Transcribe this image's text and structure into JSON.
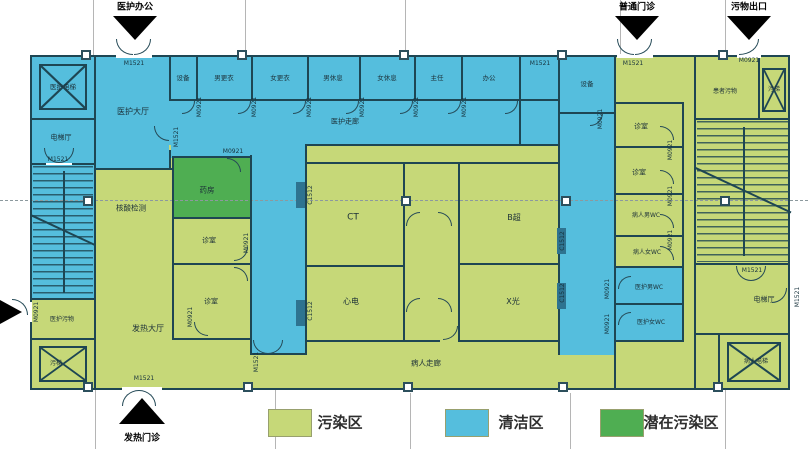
{
  "legend": {
    "items": [
      {
        "label": "污染区",
        "color": "#c6d878"
      },
      {
        "label": "清洁区",
        "color": "#55bedd"
      },
      {
        "label": "潜在污染区",
        "color": "#4fae52"
      }
    ]
  },
  "entrances": {
    "staff_office": "医护办公",
    "general_outpatient": "普通门诊",
    "waste_exit": "污物出口",
    "fever_clinic": "发热门诊"
  },
  "door_labels": {
    "m1521": "M1521",
    "m0921": "M0921",
    "c1512": "C1512"
  },
  "rooms": {
    "staff_elevator": {
      "label": "医护电梯",
      "zone": "clean"
    },
    "elevator_hall_left": {
      "label": "电梯厅",
      "zone": "clean"
    },
    "staff_hall": {
      "label": "医护大厅",
      "zone": "clean"
    },
    "equipment_1": {
      "label": "设备",
      "zone": "clean"
    },
    "men_changing": {
      "label": "男更衣",
      "zone": "clean"
    },
    "women_changing": {
      "label": "女更衣",
      "zone": "clean"
    },
    "men_rest": {
      "label": "男休息",
      "zone": "clean"
    },
    "women_rest": {
      "label": "女休息",
      "zone": "clean"
    },
    "director": {
      "label": "主任",
      "zone": "clean"
    },
    "office": {
      "label": "办公",
      "zone": "clean"
    },
    "equipment_2": {
      "label": "设备",
      "zone": "clean"
    },
    "staff_corridor": {
      "label": "医护走廊",
      "zone": "clean"
    },
    "nucleic_acid_test": {
      "label": "核酸检测",
      "zone": "contaminated"
    },
    "pharmacy": {
      "label": "药房",
      "zone": "potentially-contaminated"
    },
    "consult_1": {
      "label": "诊室",
      "zone": "contaminated"
    },
    "consult_2": {
      "label": "诊室",
      "zone": "contaminated"
    },
    "fever_hall": {
      "label": "发热大厅",
      "zone": "contaminated"
    },
    "ct_room": {
      "label": "CT",
      "zone": "contaminated"
    },
    "ecg_room": {
      "label": "心电",
      "zone": "contaminated"
    },
    "ultrasound_room": {
      "label": "B超",
      "zone": "contaminated"
    },
    "xray_room": {
      "label": "X光",
      "zone": "contaminated"
    },
    "patient_corridor": {
      "label": "病人走廊",
      "zone": "contaminated"
    },
    "consult_3": {
      "label": "诊室",
      "zone": "contaminated"
    },
    "consult_4": {
      "label": "诊室",
      "zone": "contaminated"
    },
    "patient_men_wc": {
      "label": "病人男WC",
      "zone": "contaminated"
    },
    "patient_women_wc": {
      "label": "病人女WC",
      "zone": "contaminated"
    },
    "staff_men_wc": {
      "label": "医护男WC",
      "zone": "clean"
    },
    "staff_women_wc": {
      "label": "医护女WC",
      "zone": "clean"
    },
    "patient_waste": {
      "label": "患者污物",
      "zone": "contaminated"
    },
    "waste_elevator_tr": {
      "label": "污梯",
      "zone": "contaminated"
    },
    "elevator_hall_right": {
      "label": "电梯厅",
      "zone": "contaminated"
    },
    "patient_elevator": {
      "label": "病人电梯",
      "zone": "contaminated"
    },
    "staff_waste": {
      "label": "医护污物",
      "zone": "contaminated"
    },
    "waste_elevator_bl": {
      "label": "污梯",
      "zone": "contaminated"
    }
  }
}
